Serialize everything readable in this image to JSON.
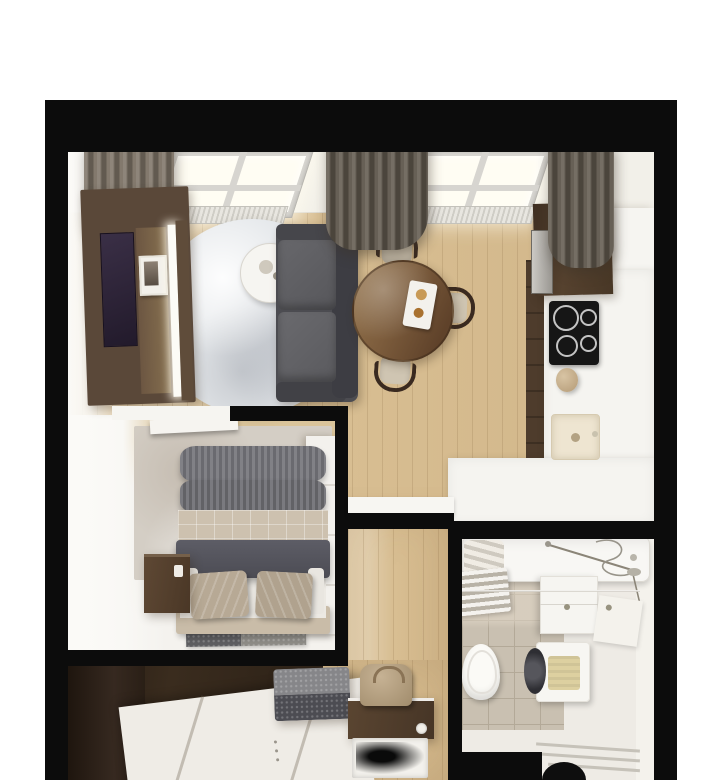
{
  "scene": {
    "kind": "3d-rendered-apartment-floor-plan",
    "view": "top-down",
    "rooms": [
      {
        "name": "living-room",
        "furniture": [
          "window",
          "window",
          "curtain-left",
          "curtain-center",
          "curtain-right",
          "radiator",
          "radiator",
          "tv-wall-unit",
          "tv-screen",
          "photo-frame",
          "round-rug",
          "side-table",
          "sofa",
          "dining-table",
          "dining-chair",
          "dining-chair",
          "dining-chair",
          "serving-tray"
        ]
      },
      {
        "name": "kitchen",
        "furniture": [
          "tall-cabinet",
          "built-in-oven",
          "white-cabinet-column",
          "l-shaped-counter",
          "cooktop",
          "kettle",
          "sink"
        ]
      },
      {
        "name": "bedroom",
        "furniture": [
          "open-door",
          "area-rug",
          "wardrobe",
          "double-bed",
          "gray-blanket",
          "quilted-duvet",
          "dark-duvet",
          "pillow",
          "pillow",
          "bedside-table",
          "foot-rug"
        ]
      },
      {
        "name": "entry-hall",
        "furniture": [
          "dark-wardrobe",
          "pouf",
          "console-bench",
          "bag",
          "doormat"
        ]
      },
      {
        "name": "bathroom",
        "furniture": [
          "bathtub",
          "shower-set",
          "towel-ladder",
          "vanity-sink",
          "corner-shelf",
          "washing-machine",
          "towel",
          "toilet",
          "towel-bars"
        ]
      }
    ]
  },
  "colors": {
    "wall": "#0c0c0c",
    "wood": "#d8be92",
    "wood-dark": "#4e3c2c",
    "white-surface": "#f5f4f0",
    "off-white": "#efece6",
    "curtain": "#7b7164",
    "curtain-dark": "#5e564b",
    "glass": "#fffdf3",
    "frame": "#d7d5d0",
    "tv-panel": "#5a4839",
    "tv-screen": "#2b2233",
    "shelf": "#6c5642",
    "rug": "#e4e7ea",
    "sofa": "#4c4c51",
    "sofa-cushion": "#606064",
    "table-wood": "#7c5e41",
    "chair-wood": "#3a2a20",
    "chair-seat": "#cfc5b2",
    "cooktop": "#161616",
    "sink": "#eee5d1",
    "blanket": "#76767c",
    "quilt": "#cdc1af",
    "duvet": "#55555d",
    "pillow": "#b7a995",
    "bedside": "#54402e",
    "bed-rug": "#d4cec5",
    "wardrobe": "#352a1e",
    "pouf-top": "#868689",
    "pouf-side": "#4c4c52",
    "console": "#4f3b2a",
    "bag": "#b7a48a",
    "tile": "#c9c0b1",
    "tile-line": "#b3a998",
    "washer-door": "#3b3b40",
    "towel": "#ddd0a0",
    "metal": "#8b8578",
    "bath-floor": "#eeebe5"
  }
}
